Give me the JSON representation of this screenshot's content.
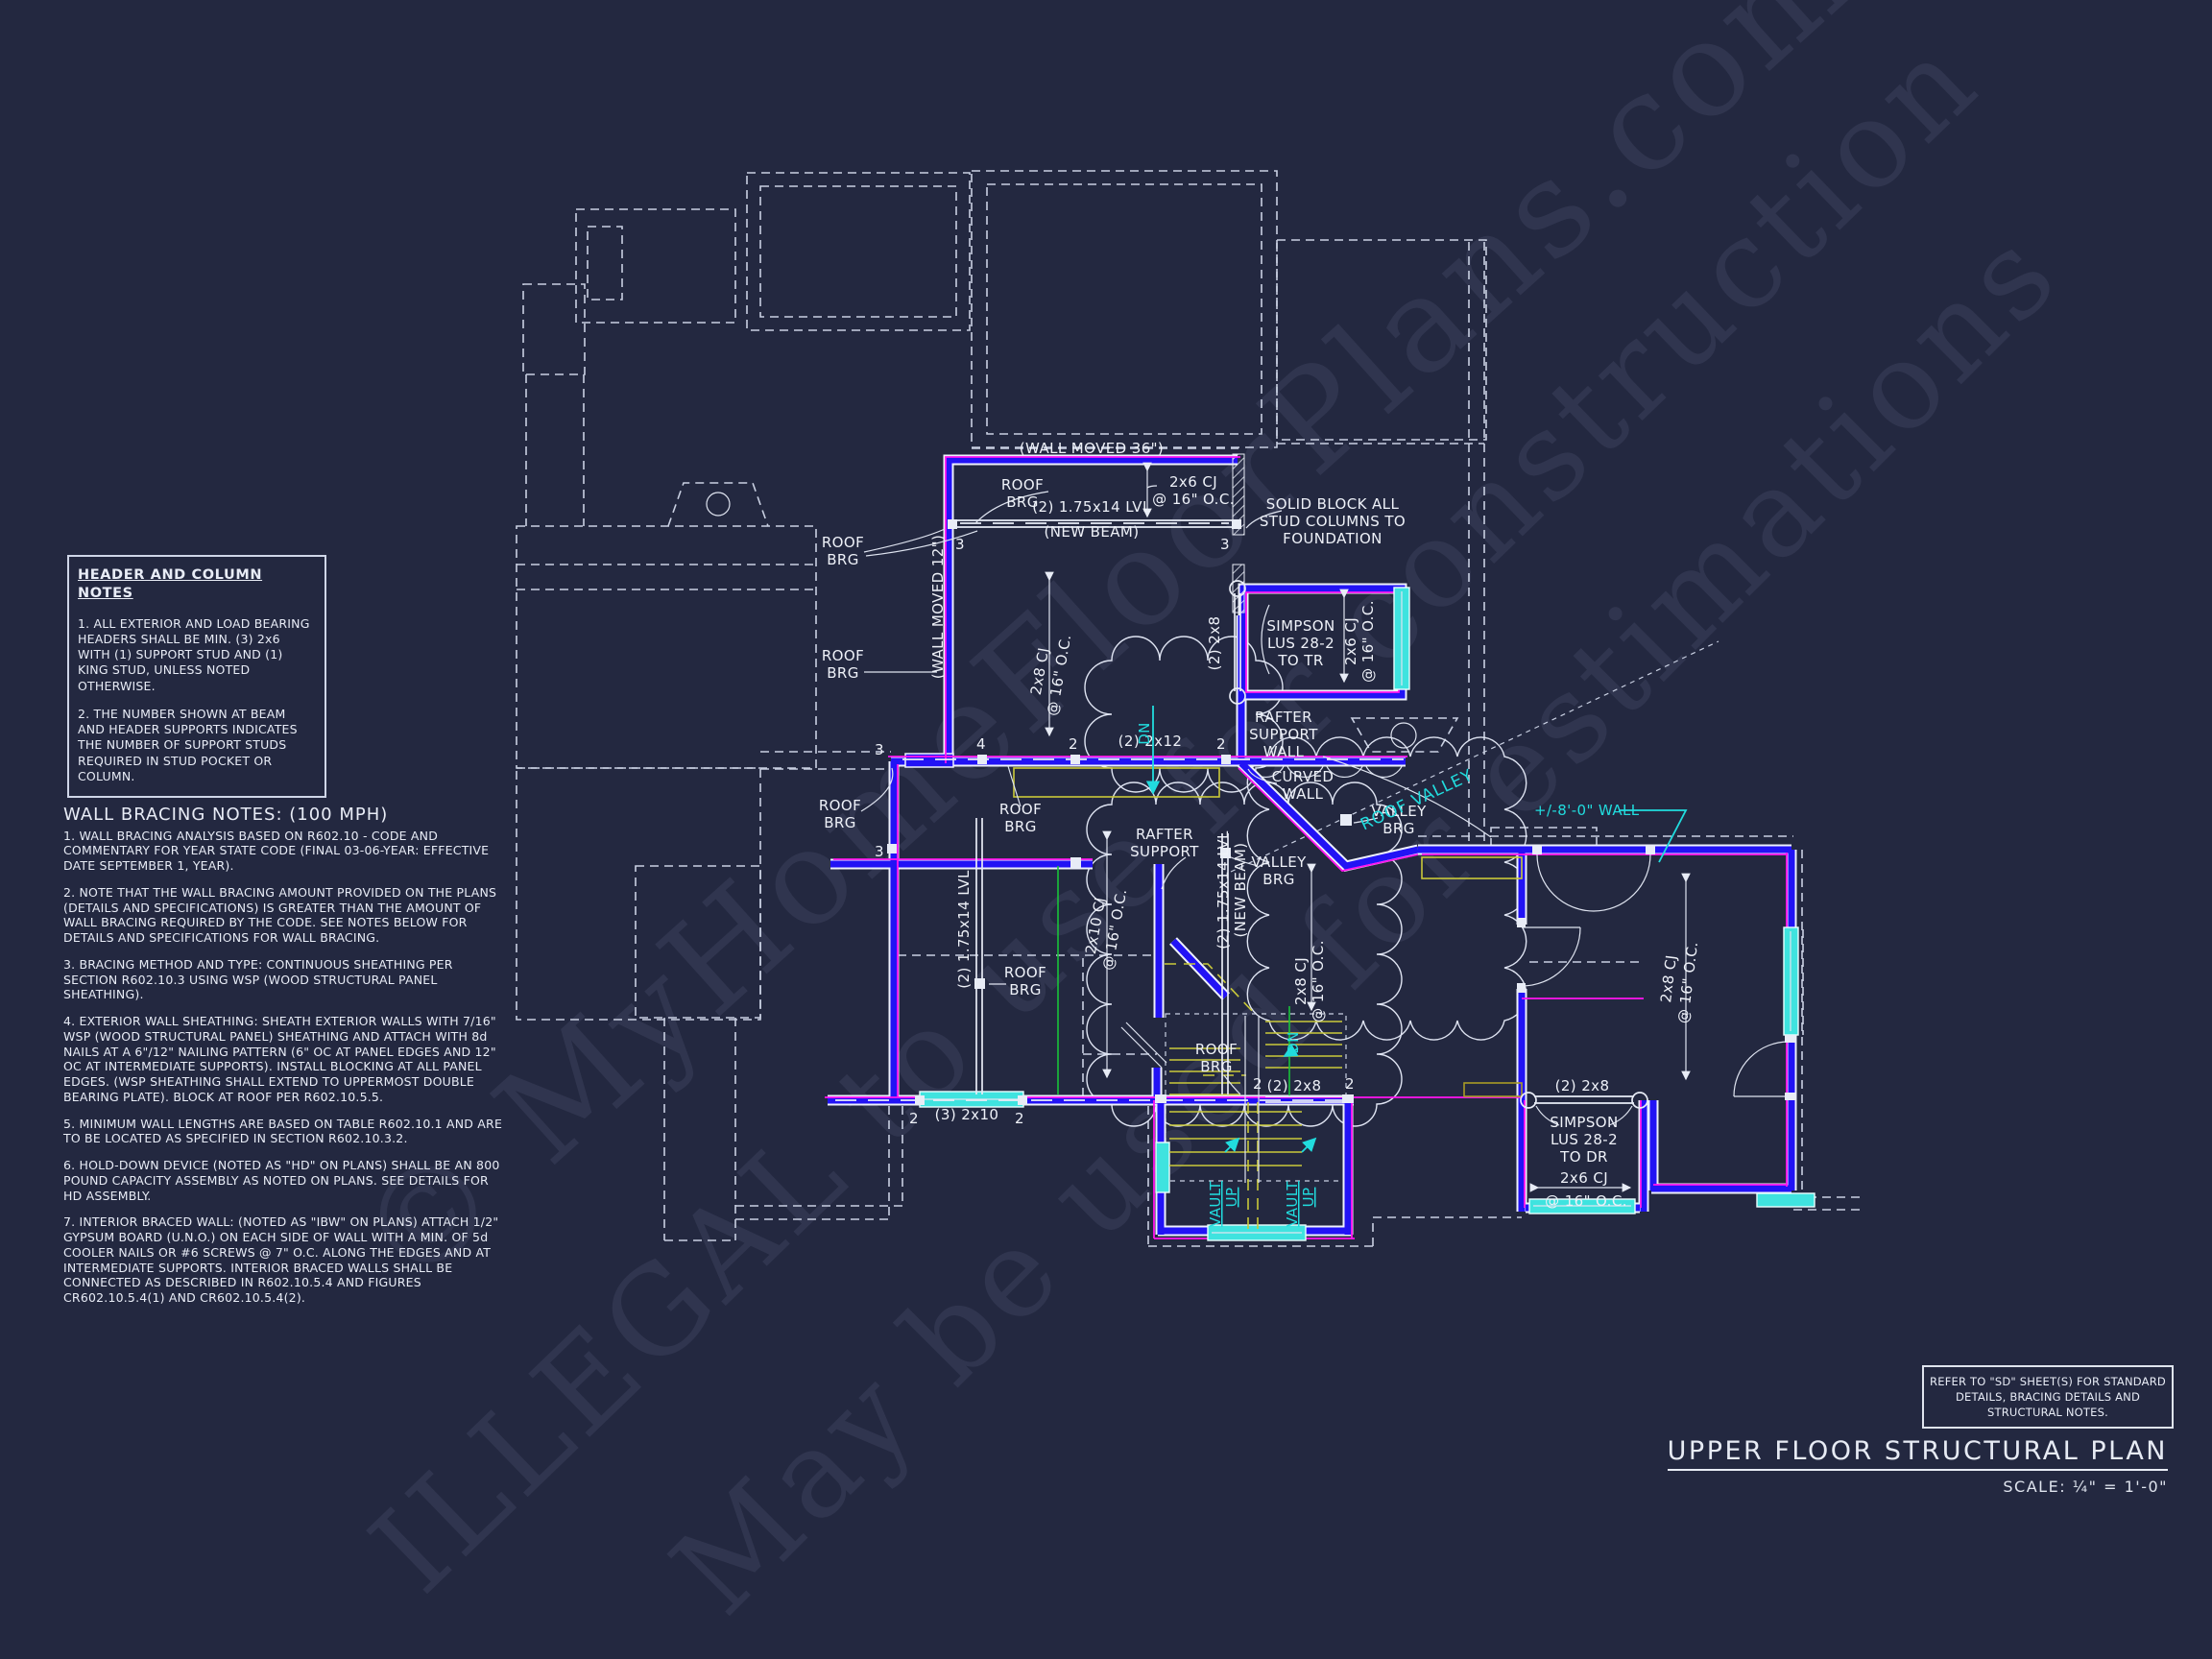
{
  "header_notes": {
    "title": "HEADER AND COLUMN NOTES",
    "note1": "1. ALL EXTERIOR AND LOAD BEARING HEADERS SHALL BE MIN. (3) 2x6 WITH (1) SUPPORT STUD AND (1) KING STUD, UNLESS NOTED OTHERWISE.",
    "note2": "2. THE NUMBER SHOWN AT BEAM AND HEADER SUPPORTS INDICATES THE NUMBER OF SUPPORT STUDS REQUIRED IN STUD POCKET OR COLUMN."
  },
  "bracing_notes": {
    "title": "WALL BRACING NOTES: (100 MPH)",
    "notes": [
      "1. WALL BRACING ANALYSIS BASED ON R602.10 - CODE AND COMMENTARY FOR YEAR STATE CODE (FINAL 03-06-YEAR: EFFECTIVE DATE SEPTEMBER 1, YEAR).",
      "2. NOTE THAT THE WALL BRACING AMOUNT PROVIDED ON THE PLANS (DETAILS AND SPECIFICATIONS) IS GREATER THAN THE AMOUNT OF WALL BRACING REQUIRED BY THE CODE. SEE NOTES BELOW FOR DETAILS AND SPECIFICATIONS FOR WALL BRACING.",
      "3. BRACING METHOD AND TYPE: CONTINUOUS SHEATHING PER SECTION R602.10.3 USING WSP (WOOD STRUCTURAL PANEL SHEATHING).",
      "4. EXTERIOR WALL SHEATHING: SHEATH EXTERIOR WALLS WITH 7/16\" WSP (WOOD STRUCTURAL PANEL) SHEATHING AND ATTACH WITH 8d NAILS AT A 6\"/12\" NAILING PATTERN (6\" OC AT PANEL EDGES AND 12\" OC AT INTERMEDIATE SUPPORTS). INSTALL BLOCKING AT ALL PANEL EDGES. (WSP SHEATHING SHALL EXTEND TO UPPERMOST DOUBLE BEARING PLATE). BLOCK AT ROOF PER R602.10.5.5.",
      "5. MINIMUM WALL LENGTHS ARE BASED ON TABLE R602.10.1 AND ARE TO BE LOCATED AS SPECIFIED IN SECTION R602.10.3.2.",
      "6. HOLD-DOWN DEVICE (NOTED AS \"HD\" ON PLANS) SHALL BE AN 800 POUND CAPACITY ASSEMBLY AS NOTED ON PLANS. SEE DETAILS FOR HD ASSEMBLY.",
      "7. INTERIOR BRACED WALL: (NOTED AS \"IBW\" ON PLANS) ATTACH 1/2\" GYPSUM BOARD (U.N.O.) ON EACH SIDE OF WALL WITH A MIN. OF 5d COOLER NAILS OR #6 SCREWS @ 7\" O.C. ALONG THE EDGES AND AT INTERMEDIATE SUPPORTS.  INTERIOR BRACED WALLS SHALL BE CONNECTED AS DESCRIBED IN R602.10.5.4 AND FIGURES CR602.10.5.4(1) AND CR602.10.5.4(2)."
    ]
  },
  "title_block": {
    "refer_note": "REFER TO \"SD\"  SHEET(S) FOR STANDARD DETAILS, BRACING DETAILS AND STRUCTURAL NOTES.",
    "title": "UPPER FLOOR STRUCTURAL PLAN",
    "scale": "SCALE: ¼\" = 1'-0\""
  },
  "watermark": {
    "line1": "© MyHomeFloorPlans.com",
    "line2": "ILLEGAL to use for construction",
    "line3": "May be used for estimations"
  },
  "plan": {
    "wall_moved_36": "(WALL MOVED 36\")",
    "wall_moved_12": "(WALL MOVED 12\")",
    "roof": "ROOF",
    "brg": "BRG",
    "lvl_175x14": "(2) 1.75x14 LVL",
    "new_beam": "(NEW BEAM)",
    "cj_2x6": "2x6 CJ",
    "cj_2x8": "2x8 CJ",
    "cj_2x10": "2x10 CJ",
    "oc_16": "@ 16\" O.C.",
    "b2_2x8": "(2) 2x8",
    "b2_2x12": "(2) 2x12",
    "b3_2x10": "(3) 2x10",
    "simpson": "SIMPSON",
    "lus_28_2": "LUS 28-2",
    "to_tr": "TO TR",
    "to_dr": "TO DR",
    "solid_block_1": "SOLID BLOCK ALL",
    "solid_block_2": "STUD COLUMNS TO",
    "solid_block_3": "FOUNDATION",
    "rafter": "RAFTER",
    "support": "SUPPORT",
    "wall": "WALL",
    "curved": "CURVED",
    "valley": "VALLEY",
    "roof_valley": "ROOF VALLEY",
    "wall_8ft": "+/-8'-0\" WALL",
    "dn": "DN",
    "vault": "VAULT",
    "up": "UP",
    "n2": "2",
    "n3": "3",
    "n4": "4"
  }
}
